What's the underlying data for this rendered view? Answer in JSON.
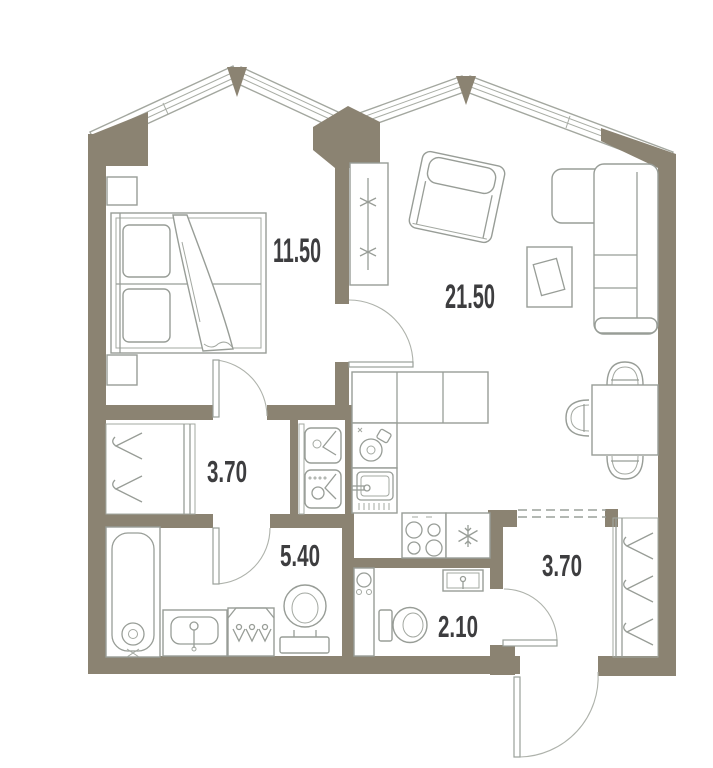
{
  "title": "apartment-floor-plan",
  "colors": {
    "background": "#ffffff",
    "walls": "#8b8372",
    "furniture_lines": "#989d97",
    "label_text": "#3d3d3f"
  },
  "rooms": [
    {
      "name": "bedroom",
      "area_label": "11.50"
    },
    {
      "name": "living-room-kitchen",
      "area_label": "21.50"
    },
    {
      "name": "hallway",
      "area_label": "3.70"
    },
    {
      "name": "bathroom",
      "area_label": "5.40"
    },
    {
      "name": "wc",
      "area_label": "2.10"
    },
    {
      "name": "entrance-hall",
      "area_label": "3.70"
    }
  ],
  "fixtures": [
    "double-bed",
    "nightstand",
    "nightstand",
    "tall-radiator",
    "armchair",
    "side-table",
    "corner-sofa",
    "dining-table",
    "dining-chairs",
    "kitchen-counter",
    "kitchen-appliance",
    "kitchen-sink",
    "stove",
    "fridge",
    "washer-dryer-stack",
    "wardrobe-hangers",
    "bathtub",
    "vanity-sink",
    "hook-cabinet",
    "toilet",
    "wc-toilet",
    "wc-counter-sink",
    "wall-sink",
    "entry-wardrobe-hangers"
  ]
}
